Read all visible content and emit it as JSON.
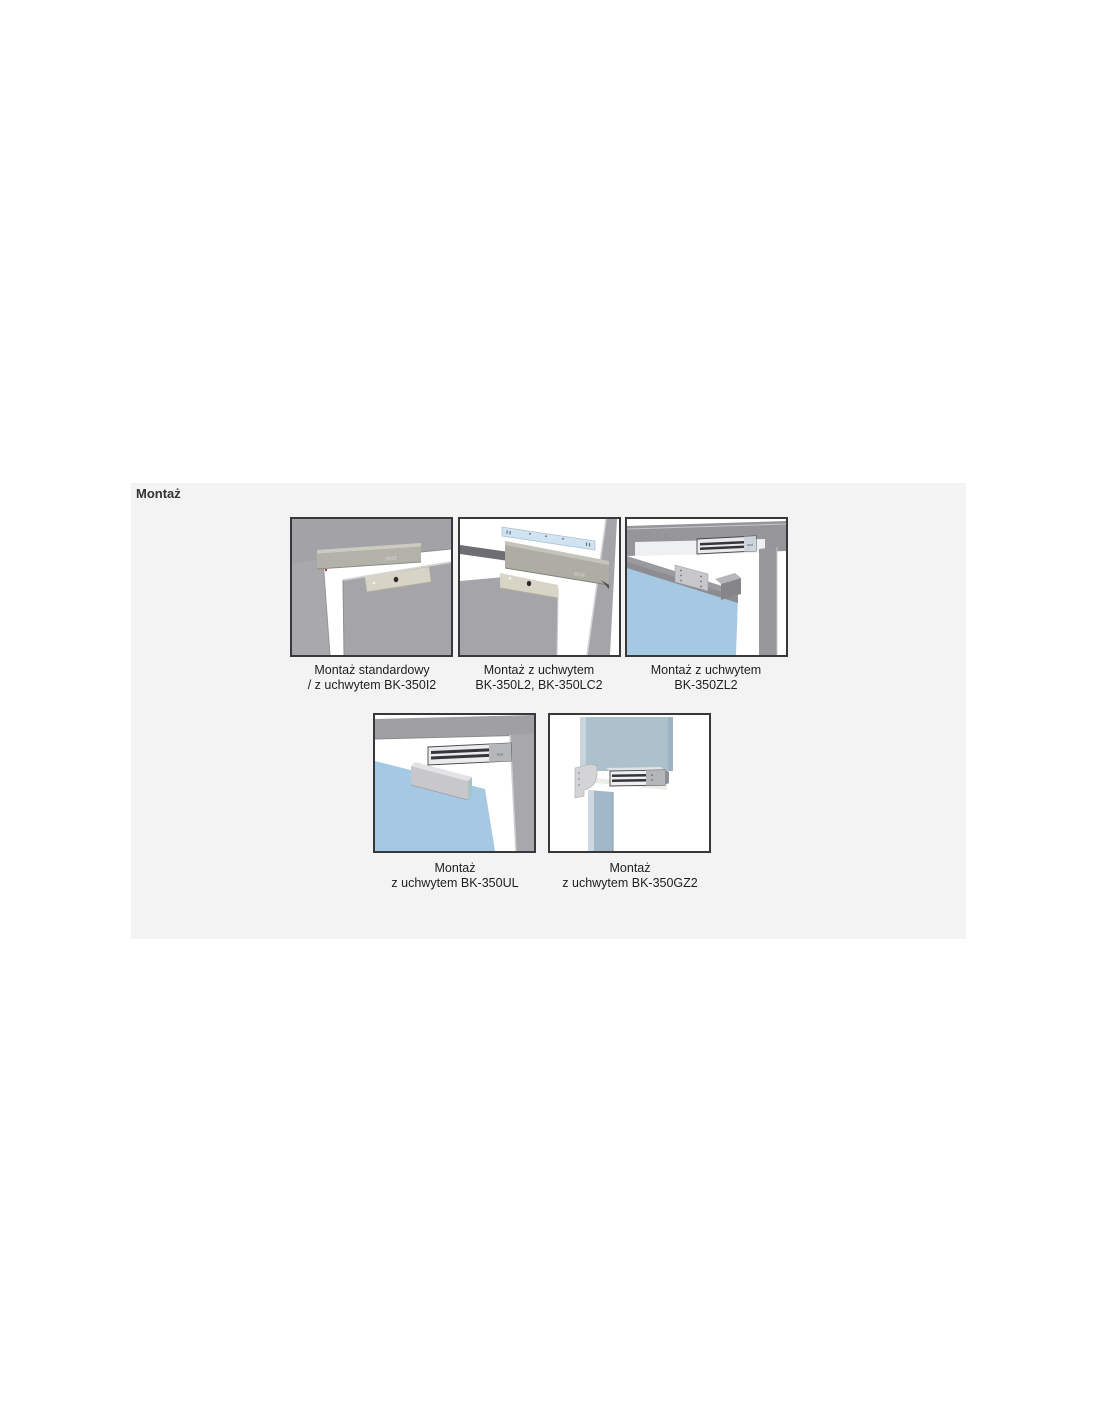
{
  "heading": "Montaż",
  "brand_label": "scot",
  "figures": [
    {
      "name": "standard-mount",
      "line1": "Montaż standardowy",
      "line2": "/ z uchwytem BK-350I2"
    },
    {
      "name": "bk-350l2-mount",
      "line1": "Montaż z uchwytem",
      "line2": "BK-350L2, BK-350LC2"
    },
    {
      "name": "bk-350zl2-mount",
      "line1": "Montaż z uchwytem",
      "line2": "BK-350ZL2"
    },
    {
      "name": "bk-350ul-mount",
      "line1": "Montaż",
      "line2": "z uchwytem BK-350UL"
    },
    {
      "name": "bk-350gz2-mount",
      "line1": "Montaż",
      "line2": "z uchwytem BK-350GZ2"
    }
  ],
  "colors": {
    "section_background": "#f3f3f3",
    "panel_border": "#38383a",
    "frame_gray": "#a3a3a7",
    "glass_blue": "#a6c9e3",
    "bracket_blue": "#cfe3f0",
    "lock_body": "#b2b2a8",
    "armature_cream": "#d7d4c5"
  }
}
